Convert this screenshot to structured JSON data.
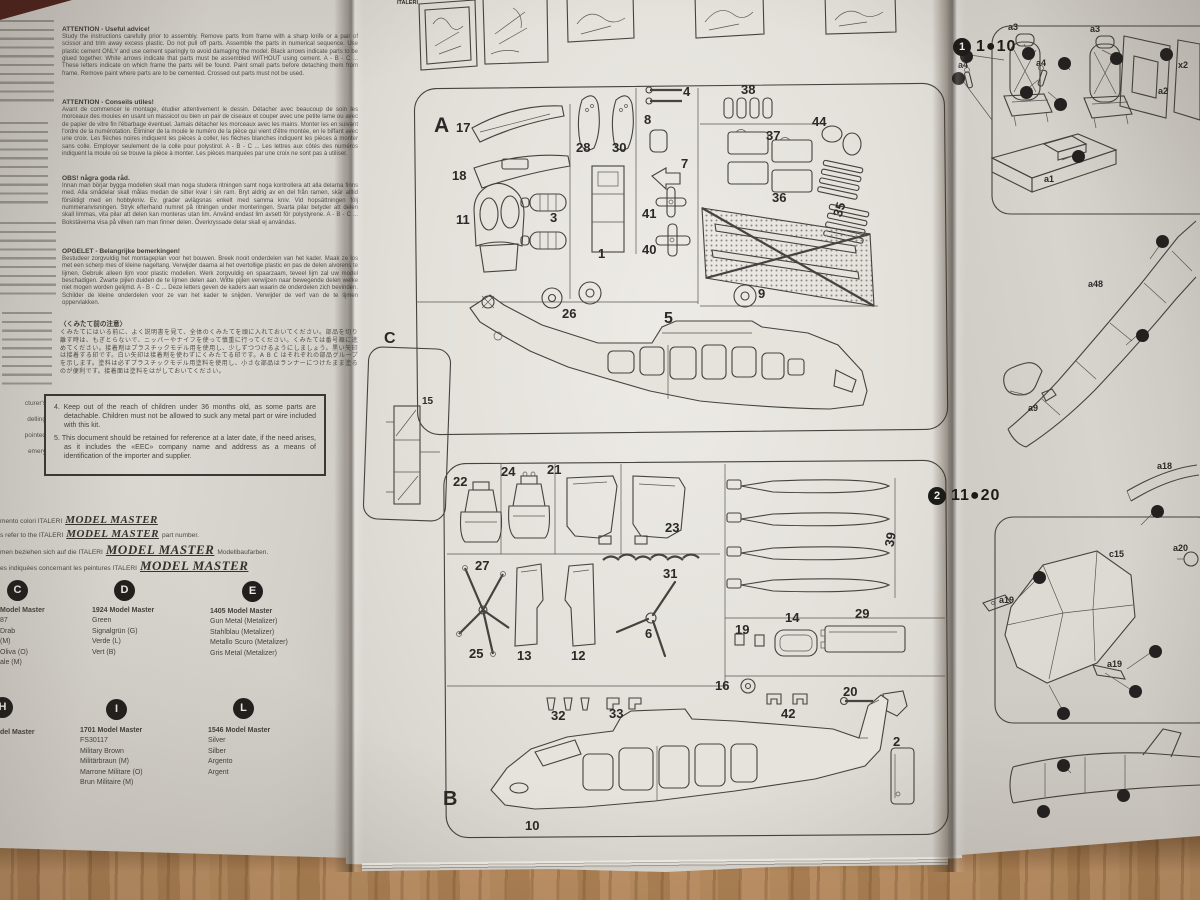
{
  "colors": {
    "wood": "#b5895b",
    "page": "#e3e0da",
    "ink": "#45423f"
  },
  "left_page": {
    "paragraphs": [
      {
        "heading": "ATTENTION - Useful advice!",
        "body": "Study the instructions carefully prior to assembly. Remove parts from frame with a sharp knife or a pair of scissor and trim away excess plastic. Do not pull off parts. Assemble the parts in numerical sequence. Use plastic cement ONLY and use cement sparingly to avoid damaging the model. Black arrows indicate parts to be glued together. White arrows indicate that parts must be assembled WITHOUT using cement. A - B - C ... These letters indicate on which frame the parts will be found. Paint small parts before detaching them from frame. Remove paint where parts are to be cemented. Crossed out parts must not be used."
      },
      {
        "heading": "ATTENTION - Conseils utiles!",
        "body": "Avant de commencer le montage, étudier attentivement le dessin. Détacher avec beaucoup de soin les morceaux des moules en usant un massicot ou bien un pair de ciseaux et couper avec une petite lame ou avec de papier de vitre fin l'ébarbage éventuel. Jamais détacher les morceaux avec les mains. Monter les en suivant l'ordre de la numérotation. Éliminer de la moule le numéro de la pièce qui vient d'être montée, en le biffant avec une croix. Les flèches noires indiquent les pièces à coller, les flèches blanches indiquent les pièces à monter sans colle. Employer seulement de la colle pour polystirol. A - B - C ... Les lettres aux côtés des numéros indiquent la moule où se trouve la pièce à monter. Les pièces marquées par une croix ne sont pas à utiliser."
      },
      {
        "heading": "OBS! några goda råd.",
        "body": "Innan man börjar bygga modellen skall man noga studera ritningen samt noga kontrollera att alla delarna finns med. Alla smådelar skall målas medan de sitter kvar i sin ram. Bryt aldrig av en del från ramen, skär alltid försiktigt med en hobbykniv. Ev. grader avlägsnas enkelt med samma kniv. Vid hopsättningen följ nummeranvisningen. Stryk efterhand numret på ritningen under monteringen. Svarta pilar betyder att delen skall limmas, vita pilar att delen kan monteras utan lim. Använd endast lim avsett för polystyrene. A - B - C ... Bokstäverna visa på vilken ram man finner delen. Överkryssade delar skall ej användas."
      },
      {
        "heading": "OPGELET - Belangrijke bemerkingen!",
        "body": "Bestudeer zorgvuldig het montageplan voor het bouwen. Breek nooit onderdelen van het kader. Maak ze los met een scherp mes of kleine nageltang. Verwijder daarna al het overtollige plastic en pas de delen alvorens te lijmen. Gebruik alleen lijm voor plastic modellen. Werk zorgvuldig en spaarzaam, teveel lijm zal uw model beschadigen. Zwarte pijlen duiden de te lijmen delen aan. Witte pijlen verwijzen naar bewegende delen welke niet mogen worden gelijmd. A - B - C ... Deze letters geven de kaders aan waarin de onderdelen zich bevinden. Schilder de kleine onderdelen voor ze van het kader te snijden. Verwijder de verf van de te lijmen oppervlakken."
      },
      {
        "heading": "〈くみたて前の注意〉",
        "body": "くみたてにはいる前に、よく説明書を見て、全体のくみたてを頭に入れておいてください。部品を切り離す時は、もぎとらないで、ニッパーやナイフを使って慎重に行ってください。くみたては番号順に進めてください。接着剤はプラスチックモデル用を使用し、少しずつつけるようにしましょう。黒い矢印は接着する印です。白い矢印は接着剤を使わずにくみたてる印です。A B C はそれぞれの部品グループを示します。塗料は必ずプラスチックモデル用塗料を使用し、小さな部品はランナーにつけたまま塗るのが便利です。接着面は塗料をはがしておいてください。"
      }
    ],
    "margin_fragments": [
      "cturer's",
      "delling",
      "pointed",
      "emery"
    ],
    "safety_box": {
      "item4": "4. Keep out of the reach of children under 36 months old, as some parts are detachable. Children must not be allowed to suck any metal part or wire included with this kit.",
      "item5": "5. This document should be retained for reference at a later date, if the need arises, as it includes the «EEC» company name and address as a means of identification of the importer and supplier."
    },
    "paint_reference_lines": [
      {
        "prefix": "mento colori  ITALERI",
        "logo": "MODEL MASTER",
        "suffix": ""
      },
      {
        "prefix": "s refer to the  ITALERI",
        "logo": "MODEL MASTER",
        "suffix": "part number."
      },
      {
        "prefix": "men beziehen sich auf die  ITALERI",
        "logo": "MODEL MASTER",
        "suffix": "Modellbaufarben."
      },
      {
        "prefix": "es indiquées concernant les peintures  ITALERI",
        "logo": "MODEL MASTER",
        "suffix": ""
      }
    ],
    "paints": [
      {
        "letter": "C",
        "lines": [
          "Model Master",
          "87",
          "Drab",
          "(M)",
          "Oliva  (O)",
          "ale  (M)"
        ]
      },
      {
        "letter": "D",
        "lines": [
          "1924  Model  Master",
          "Green",
          "Signalgrün  (G)",
          "Verde  (L)",
          "Vert  (B)"
        ]
      },
      {
        "letter": "E",
        "lines": [
          "1405 Model Master",
          "Gun Metal (Metalizer)",
          "Stahlblau (Metalizer)",
          "Metallo Scuro (Metalizer)",
          "Gris Metal (Metalizer)"
        ]
      },
      {
        "letter": "H",
        "lines": [
          "del  Master"
        ]
      },
      {
        "letter": "I",
        "lines": [
          "1701  Model  Master",
          "FS30117",
          "Military  Brown",
          "Militärbraun  (M)",
          "Marrone  Militare  (O)",
          "Brun  Militaire  (M)"
        ]
      },
      {
        "letter": "L",
        "lines": [
          "1546 Model Master",
          "Silver",
          "Silber",
          "Argento",
          "Argent"
        ]
      }
    ]
  },
  "right_page": {
    "step1": {
      "number": "1",
      "range": "1●10"
    },
    "step2": {
      "number": "2",
      "range": "11●20"
    }
  },
  "labels": {
    "strip": [
      {
        "x": 2,
        "y": 6,
        "t": "ITALERI",
        "s": 5.5
      }
    ],
    "sprue_a": [
      {
        "x": 34,
        "y": 40,
        "t": "A",
        "s": 21
      },
      {
        "x": 56,
        "y": 46,
        "t": "17"
      },
      {
        "x": 52,
        "y": 94,
        "t": "18"
      },
      {
        "x": 56,
        "y": 138,
        "t": "11"
      },
      {
        "x": 176,
        "y": 66,
        "t": "28"
      },
      {
        "x": 212,
        "y": 66,
        "t": "30"
      },
      {
        "x": 150,
        "y": 136,
        "t": "3"
      },
      {
        "x": 198,
        "y": 172,
        "t": "1"
      },
      {
        "x": 244,
        "y": 38,
        "t": "8"
      },
      {
        "x": 281,
        "y": 82,
        "t": "7"
      },
      {
        "x": 242,
        "y": 132,
        "t": "41"
      },
      {
        "x": 242,
        "y": 168,
        "t": "40"
      },
      {
        "x": 283,
        "y": 10,
        "t": "4"
      },
      {
        "x": 341,
        "y": 8,
        "t": "38"
      },
      {
        "x": 366,
        "y": 54,
        "t": "37"
      },
      {
        "x": 372,
        "y": 116,
        "t": "36"
      },
      {
        "x": 412,
        "y": 40,
        "t": "44"
      },
      {
        "x": 432,
        "y": 128,
        "t": "35",
        "r": -72
      },
      {
        "x": 358,
        "y": 212,
        "t": "9"
      },
      {
        "x": 162,
        "y": 232,
        "t": "26"
      },
      {
        "x": 264,
        "y": 236,
        "t": "5",
        "s": 16
      }
    ],
    "sprue_c": [
      {
        "x": 28,
        "y": -2,
        "t": "C",
        "s": 16
      },
      {
        "x": 66,
        "y": 64,
        "t": "15",
        "s": 10
      }
    ],
    "sprue_b": [
      {
        "x": 18,
        "y": 26,
        "t": "22"
      },
      {
        "x": 66,
        "y": 16,
        "t": "24"
      },
      {
        "x": 112,
        "y": 14,
        "t": "21"
      },
      {
        "x": 230,
        "y": 72,
        "t": "23"
      },
      {
        "x": 40,
        "y": 110,
        "t": "27"
      },
      {
        "x": 34,
        "y": 198,
        "t": "25"
      },
      {
        "x": 82,
        "y": 200,
        "t": "13"
      },
      {
        "x": 136,
        "y": 200,
        "t": "12"
      },
      {
        "x": 228,
        "y": 118,
        "t": "31"
      },
      {
        "x": 210,
        "y": 178,
        "t": "6"
      },
      {
        "x": 448,
        "y": 84,
        "t": "39",
        "r": -80
      },
      {
        "x": 350,
        "y": 162,
        "t": "14"
      },
      {
        "x": 420,
        "y": 158,
        "t": "29"
      },
      {
        "x": 300,
        "y": 174,
        "t": "19"
      },
      {
        "x": 280,
        "y": 230,
        "t": "16"
      },
      {
        "x": 346,
        "y": 258,
        "t": "42"
      },
      {
        "x": 408,
        "y": 236,
        "t": "20"
      },
      {
        "x": 116,
        "y": 260,
        "t": "32"
      },
      {
        "x": 174,
        "y": 258,
        "t": "33"
      },
      {
        "x": 458,
        "y": 286,
        "t": "2"
      },
      {
        "x": 90,
        "y": 370,
        "t": "10"
      },
      {
        "x": 8,
        "y": 340,
        "t": "B",
        "s": 20
      }
    ],
    "step1": [
      {
        "x": 56,
        "y": 22,
        "t": "a3",
        "s": 9
      },
      {
        "x": 138,
        "y": 24,
        "t": "a3",
        "s": 9
      },
      {
        "x": 84,
        "y": 58,
        "t": "a4",
        "s": 9
      },
      {
        "x": 6,
        "y": 60,
        "t": "a4",
        "s": 9
      },
      {
        "x": 206,
        "y": 86,
        "t": "a2",
        "s": 9
      },
      {
        "x": 226,
        "y": 60,
        "t": "x2",
        "s": 9
      },
      {
        "x": 92,
        "y": 174,
        "t": "a1",
        "s": 9
      },
      {
        "x": 8,
        "y": 50,
        "d": 1
      },
      {
        "x": 70,
        "y": 47,
        "d": 1
      },
      {
        "x": 106,
        "y": 57,
        "d": 1
      },
      {
        "x": 158,
        "y": 52,
        "d": 1
      },
      {
        "x": 208,
        "y": 48,
        "d": 1
      },
      {
        "x": 68,
        "y": 86,
        "d": 1
      },
      {
        "x": 102,
        "y": 98,
        "d": 1
      },
      {
        "x": 120,
        "y": 150,
        "d": 1
      },
      {
        "x": 0,
        "y": 72,
        "d": 1
      }
    ],
    "midright": [
      {
        "x": 98,
        "y": 64,
        "t": "a48",
        "s": 9
      },
      {
        "x": 38,
        "y": 188,
        "t": "a9",
        "s": 9
      },
      {
        "x": 166,
        "y": 20,
        "d": 1
      },
      {
        "x": 146,
        "y": 114,
        "d": 1
      }
    ],
    "step2": [
      {
        "x": 212,
        "y": 6,
        "t": "a18",
        "s": 9
      },
      {
        "x": 228,
        "y": 88,
        "t": "a20",
        "s": 9
      },
      {
        "x": 164,
        "y": 94,
        "t": "c15",
        "s": 9
      },
      {
        "x": 54,
        "y": 140,
        "t": "a19",
        "s": 9
      },
      {
        "x": 162,
        "y": 204,
        "t": "a19",
        "s": 9
      },
      {
        "x": 88,
        "y": 116,
        "d": 1
      },
      {
        "x": 206,
        "y": 50,
        "d": 1
      },
      {
        "x": 204,
        "y": 190,
        "d": 1
      },
      {
        "x": 184,
        "y": 230,
        "d": 1
      },
      {
        "x": 112,
        "y": 252,
        "d": 1
      }
    ],
    "bottomright": [
      {
        "x": 52,
        "y": 34,
        "d": 1
      },
      {
        "x": 112,
        "y": 64,
        "d": 1
      },
      {
        "x": 32,
        "y": 80,
        "d": 1
      }
    ]
  }
}
